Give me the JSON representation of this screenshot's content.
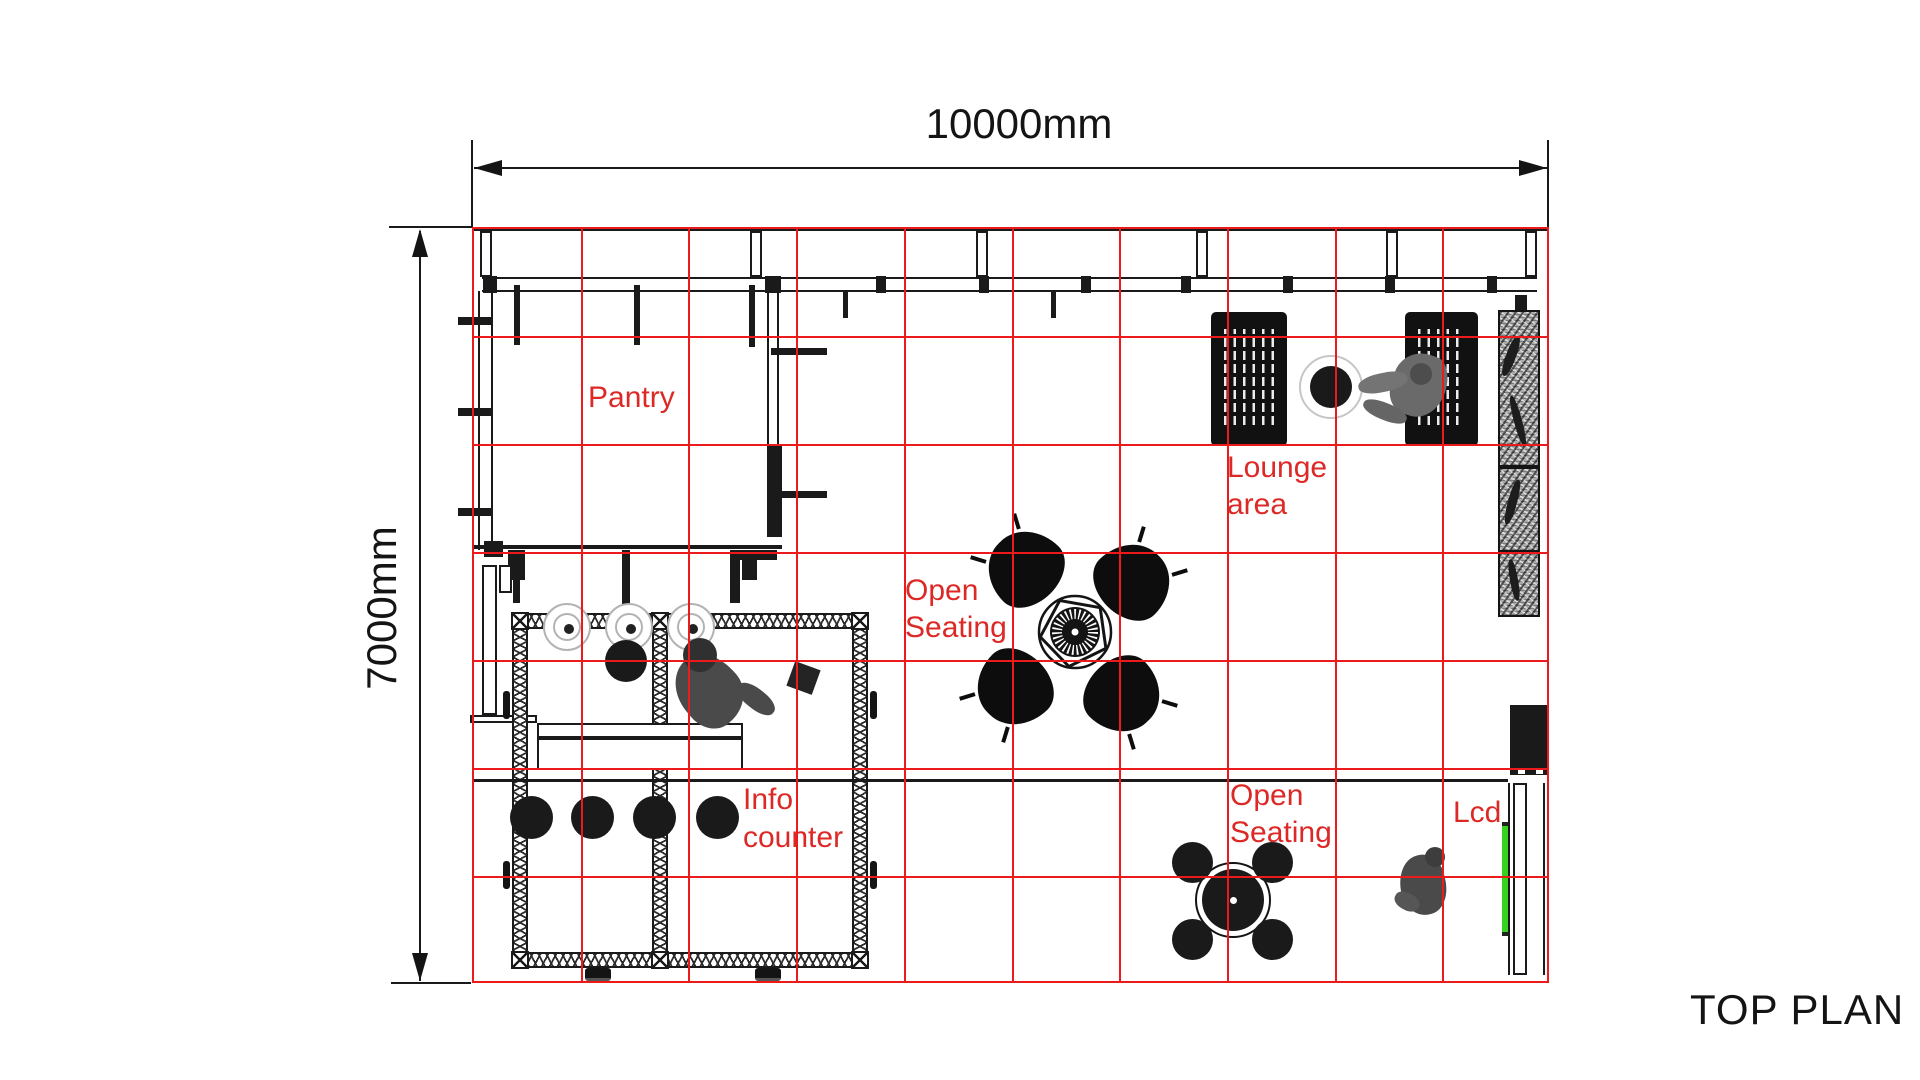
{
  "title": "TOP PLAN",
  "dimensions": {
    "width": "10000mm",
    "height": "7000mm"
  },
  "labels": {
    "pantry": "Pantry",
    "lounge": [
      "Lounge",
      "area"
    ],
    "open_seating_center": [
      "Open",
      "Seating"
    ],
    "open_seating_right": [
      "Open",
      "Seating"
    ],
    "info_counter": [
      "Info",
      "counter"
    ],
    "lcd": "Lcd"
  },
  "grid": {
    "columns": 10,
    "rows": 7
  },
  "colors": {
    "grid_red": "#ec1a1a",
    "label_red": "#dc2926",
    "line_black": "#1a1a1a",
    "lcd_green": "#35d31f"
  }
}
